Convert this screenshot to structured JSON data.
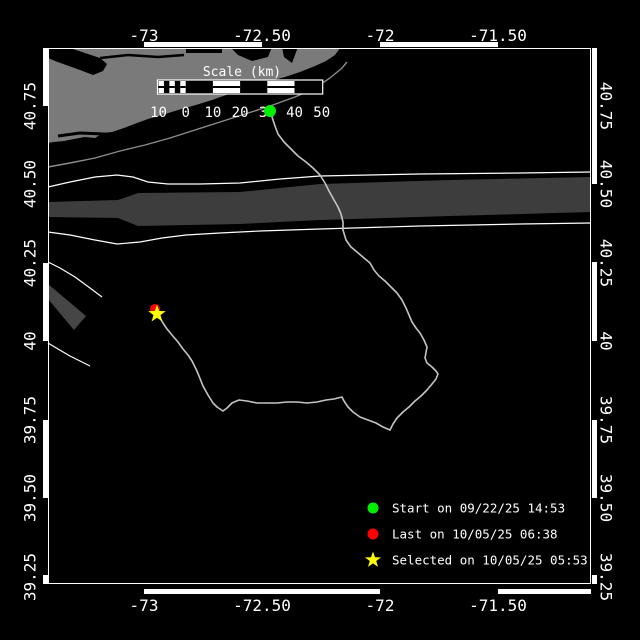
{
  "colors": {
    "background": "#000000",
    "land": "#7a7a7a",
    "water": "#000000",
    "separation_zone": "#3d3d3d",
    "sw_zone": "#464646",
    "track": "#c4c4c4",
    "coast_contour": "#8c8c8c",
    "boundary_line": "#ffffff",
    "start": "#00ee00",
    "last": "#ff0000",
    "selected": "#ffff00",
    "text": "#ffffff"
  },
  "axes": {
    "top": [
      {
        "label": "-73",
        "x": 144
      },
      {
        "label": "-72.50",
        "x": 262
      },
      {
        "label": "-72",
        "x": 380
      },
      {
        "label": "-71.50",
        "x": 498
      }
    ],
    "bottom": [
      {
        "label": "-73",
        "x": 144
      },
      {
        "label": "-72.50",
        "x": 262
      },
      {
        "label": "-72",
        "x": 380
      },
      {
        "label": "-71.50",
        "x": 498
      }
    ],
    "left": [
      {
        "label": "40.75",
        "y": 106
      },
      {
        "label": "40.50",
        "y": 184
      },
      {
        "label": "40.25",
        "y": 263
      },
      {
        "label": "40",
        "y": 341
      },
      {
        "label": "39.75",
        "y": 420
      },
      {
        "label": "39.50",
        "y": 498
      },
      {
        "label": "39.25",
        "y": 577
      }
    ],
    "right": [
      {
        "label": "40.75",
        "y": 106
      },
      {
        "label": "40.50",
        "y": 184
      },
      {
        "label": "40.25",
        "y": 263
      },
      {
        "label": "40",
        "y": 341
      },
      {
        "label": "39.75",
        "y": 420
      },
      {
        "label": "39.50",
        "y": 498
      },
      {
        "label": "39.25",
        "y": 577
      }
    ]
  },
  "scale_bar": {
    "title": "Scale (km)",
    "tick_labels": [
      "10",
      "0",
      "10",
      "20",
      "30",
      "40",
      "50"
    ]
  },
  "legend": {
    "items": [
      {
        "marker": "circle",
        "color": "#00ee00",
        "label": "Start on 09/22/25 14:53"
      },
      {
        "marker": "circle",
        "color": "#ff0000",
        "label": "Last on 10/05/25 06:38"
      },
      {
        "marker": "star",
        "color": "#ffff00",
        "label": "Selected on 10/05/25 05:53"
      }
    ]
  },
  "markers": {
    "start": {
      "x": 270,
      "y": 111
    },
    "last": {
      "x": 155,
      "y": 309
    },
    "selected": {
      "x": 157,
      "y": 314
    }
  },
  "track_points": [
    [
      272,
      117
    ],
    [
      275,
      126
    ],
    [
      278,
      134
    ],
    [
      284,
      142
    ],
    [
      291,
      149
    ],
    [
      298,
      156
    ],
    [
      306,
      162
    ],
    [
      313,
      168
    ],
    [
      320,
      175
    ],
    [
      325,
      183
    ],
    [
      329,
      191
    ],
    [
      334,
      200
    ],
    [
      338,
      207
    ],
    [
      341,
      214
    ],
    [
      343,
      222
    ],
    [
      343,
      230
    ],
    [
      346,
      240
    ],
    [
      351,
      247
    ],
    [
      357,
      252
    ],
    [
      364,
      258
    ],
    [
      370,
      263
    ],
    [
      374,
      270
    ],
    [
      379,
      276
    ],
    [
      385,
      281
    ],
    [
      391,
      287
    ],
    [
      397,
      293
    ],
    [
      402,
      300
    ],
    [
      406,
      308
    ],
    [
      409,
      315
    ],
    [
      412,
      322
    ],
    [
      416,
      328
    ],
    [
      420,
      333
    ],
    [
      424,
      340
    ],
    [
      427,
      347
    ],
    [
      425,
      358
    ],
    [
      427,
      363
    ],
    [
      432,
      367
    ],
    [
      436,
      371
    ],
    [
      438,
      374
    ],
    [
      436,
      379
    ],
    [
      432,
      384
    ],
    [
      427,
      390
    ],
    [
      421,
      396
    ],
    [
      415,
      401
    ],
    [
      409,
      407
    ],
    [
      403,
      412
    ],
    [
      397,
      418
    ],
    [
      393,
      424
    ],
    [
      390,
      430
    ],
    [
      383,
      427
    ],
    [
      376,
      423
    ],
    [
      368,
      420
    ],
    [
      360,
      417
    ],
    [
      353,
      412
    ],
    [
      348,
      407
    ],
    [
      344,
      401
    ],
    [
      342,
      397
    ],
    [
      334,
      399
    ],
    [
      326,
      400
    ],
    [
      317,
      402
    ],
    [
      307,
      403
    ],
    [
      297,
      402
    ],
    [
      287,
      402
    ],
    [
      277,
      403
    ],
    [
      267,
      403
    ],
    [
      257,
      403
    ],
    [
      247,
      401
    ],
    [
      239,
      400
    ],
    [
      232,
      403
    ],
    [
      227,
      408
    ],
    [
      223,
      411
    ],
    [
      217,
      407
    ],
    [
      213,
      403
    ],
    [
      208,
      395
    ],
    [
      203,
      386
    ],
    [
      199,
      376
    ],
    [
      196,
      369
    ],
    [
      192,
      361
    ],
    [
      188,
      355
    ],
    [
      183,
      349
    ],
    [
      178,
      342
    ],
    [
      172,
      335
    ],
    [
      167,
      329
    ],
    [
      163,
      323
    ],
    [
      160,
      318
    ],
    [
      158,
      314
    ]
  ],
  "geography": {
    "land": [
      [
        48,
        48
      ],
      [
        340,
        48
      ],
      [
        335,
        55
      ],
      [
        326,
        61
      ],
      [
        315,
        66
      ],
      [
        300,
        72
      ],
      [
        285,
        77
      ],
      [
        270,
        81
      ],
      [
        255,
        86
      ],
      [
        240,
        91
      ],
      [
        226,
        95
      ],
      [
        212,
        100
      ],
      [
        196,
        105
      ],
      [
        178,
        110
      ],
      [
        162,
        115
      ],
      [
        148,
        119
      ],
      [
        137,
        123
      ],
      [
        124,
        128
      ],
      [
        112,
        132
      ],
      [
        103,
        133
      ],
      [
        95,
        138
      ],
      [
        85,
        137
      ],
      [
        74,
        139
      ],
      [
        64,
        141
      ],
      [
        54,
        142
      ],
      [
        48,
        143
      ]
    ],
    "bay_west": [
      [
        48,
        48
      ],
      [
        70,
        48
      ],
      [
        85,
        53
      ],
      [
        100,
        58
      ],
      [
        107,
        64
      ],
      [
        103,
        71
      ],
      [
        93,
        75
      ],
      [
        80,
        70
      ],
      [
        66,
        65
      ],
      [
        55,
        61
      ],
      [
        48,
        58
      ]
    ],
    "bay_channel": [
      [
        100,
        58
      ],
      [
        128,
        55
      ],
      [
        158,
        57
      ],
      [
        184,
        55
      ]
    ],
    "bay_mid": {
      "x": 186,
      "y": 47,
      "w": 36,
      "h": 6
    },
    "bay_east": [
      [
        230,
        47
      ],
      [
        272,
        47
      ],
      [
        268,
        57
      ],
      [
        252,
        61
      ],
      [
        238,
        55
      ]
    ],
    "bay_inlet": [
      [
        282,
        47
      ],
      [
        298,
        47
      ],
      [
        292,
        63
      ],
      [
        284,
        57
      ]
    ],
    "lagoon": [
      [
        58,
        136
      ],
      [
        80,
        133
      ],
      [
        104,
        134
      ],
      [
        126,
        135
      ],
      [
        146,
        138
      ]
    ],
    "coast_contour": [
      [
        48,
        167
      ],
      [
        70,
        163
      ],
      [
        95,
        158
      ],
      [
        120,
        151
      ],
      [
        145,
        145
      ],
      [
        170,
        138
      ],
      [
        195,
        130
      ],
      [
        220,
        122
      ],
      [
        245,
        114
      ],
      [
        270,
        106
      ],
      [
        295,
        97
      ],
      [
        315,
        88
      ],
      [
        330,
        78
      ],
      [
        342,
        68
      ],
      [
        347,
        62
      ]
    ],
    "fairway_upper": [
      [
        48,
        187
      ],
      [
        70,
        182
      ],
      [
        95,
        177
      ],
      [
        117,
        175
      ],
      [
        133,
        177
      ],
      [
        148,
        182
      ],
      [
        168,
        184
      ],
      [
        200,
        184
      ],
      [
        240,
        183
      ],
      [
        280,
        179
      ],
      [
        320,
        176
      ],
      [
        420,
        174
      ],
      [
        520,
        173
      ],
      [
        591,
        172
      ]
    ],
    "fairway_lower": [
      [
        48,
        232
      ],
      [
        70,
        235
      ],
      [
        95,
        240
      ],
      [
        117,
        244
      ],
      [
        140,
        242
      ],
      [
        162,
        238
      ],
      [
        186,
        235
      ],
      [
        220,
        233
      ],
      [
        260,
        231
      ],
      [
        320,
        229
      ],
      [
        420,
        226
      ],
      [
        520,
        224
      ],
      [
        591,
        223
      ]
    ],
    "approach_line": [
      [
        48,
        262
      ],
      [
        60,
        268
      ],
      [
        75,
        277
      ],
      [
        90,
        288
      ],
      [
        102,
        297
      ]
    ],
    "sw_line": [
      [
        48,
        343
      ],
      [
        58,
        349
      ],
      [
        70,
        356
      ],
      [
        82,
        362
      ],
      [
        90,
        366
      ]
    ],
    "separation_zone": [
      [
        48,
        202
      ],
      [
        118,
        200
      ],
      [
        138,
        193
      ],
      [
        240,
        192
      ],
      [
        320,
        184
      ],
      [
        450,
        180
      ],
      [
        591,
        177
      ],
      [
        591,
        212
      ],
      [
        450,
        216
      ],
      [
        320,
        220
      ],
      [
        240,
        224
      ],
      [
        138,
        226
      ],
      [
        118,
        218
      ],
      [
        48,
        217
      ]
    ],
    "sw_zone": [
      [
        48,
        284
      ],
      [
        86,
        316
      ],
      [
        74,
        330
      ],
      [
        48,
        299
      ]
    ]
  }
}
